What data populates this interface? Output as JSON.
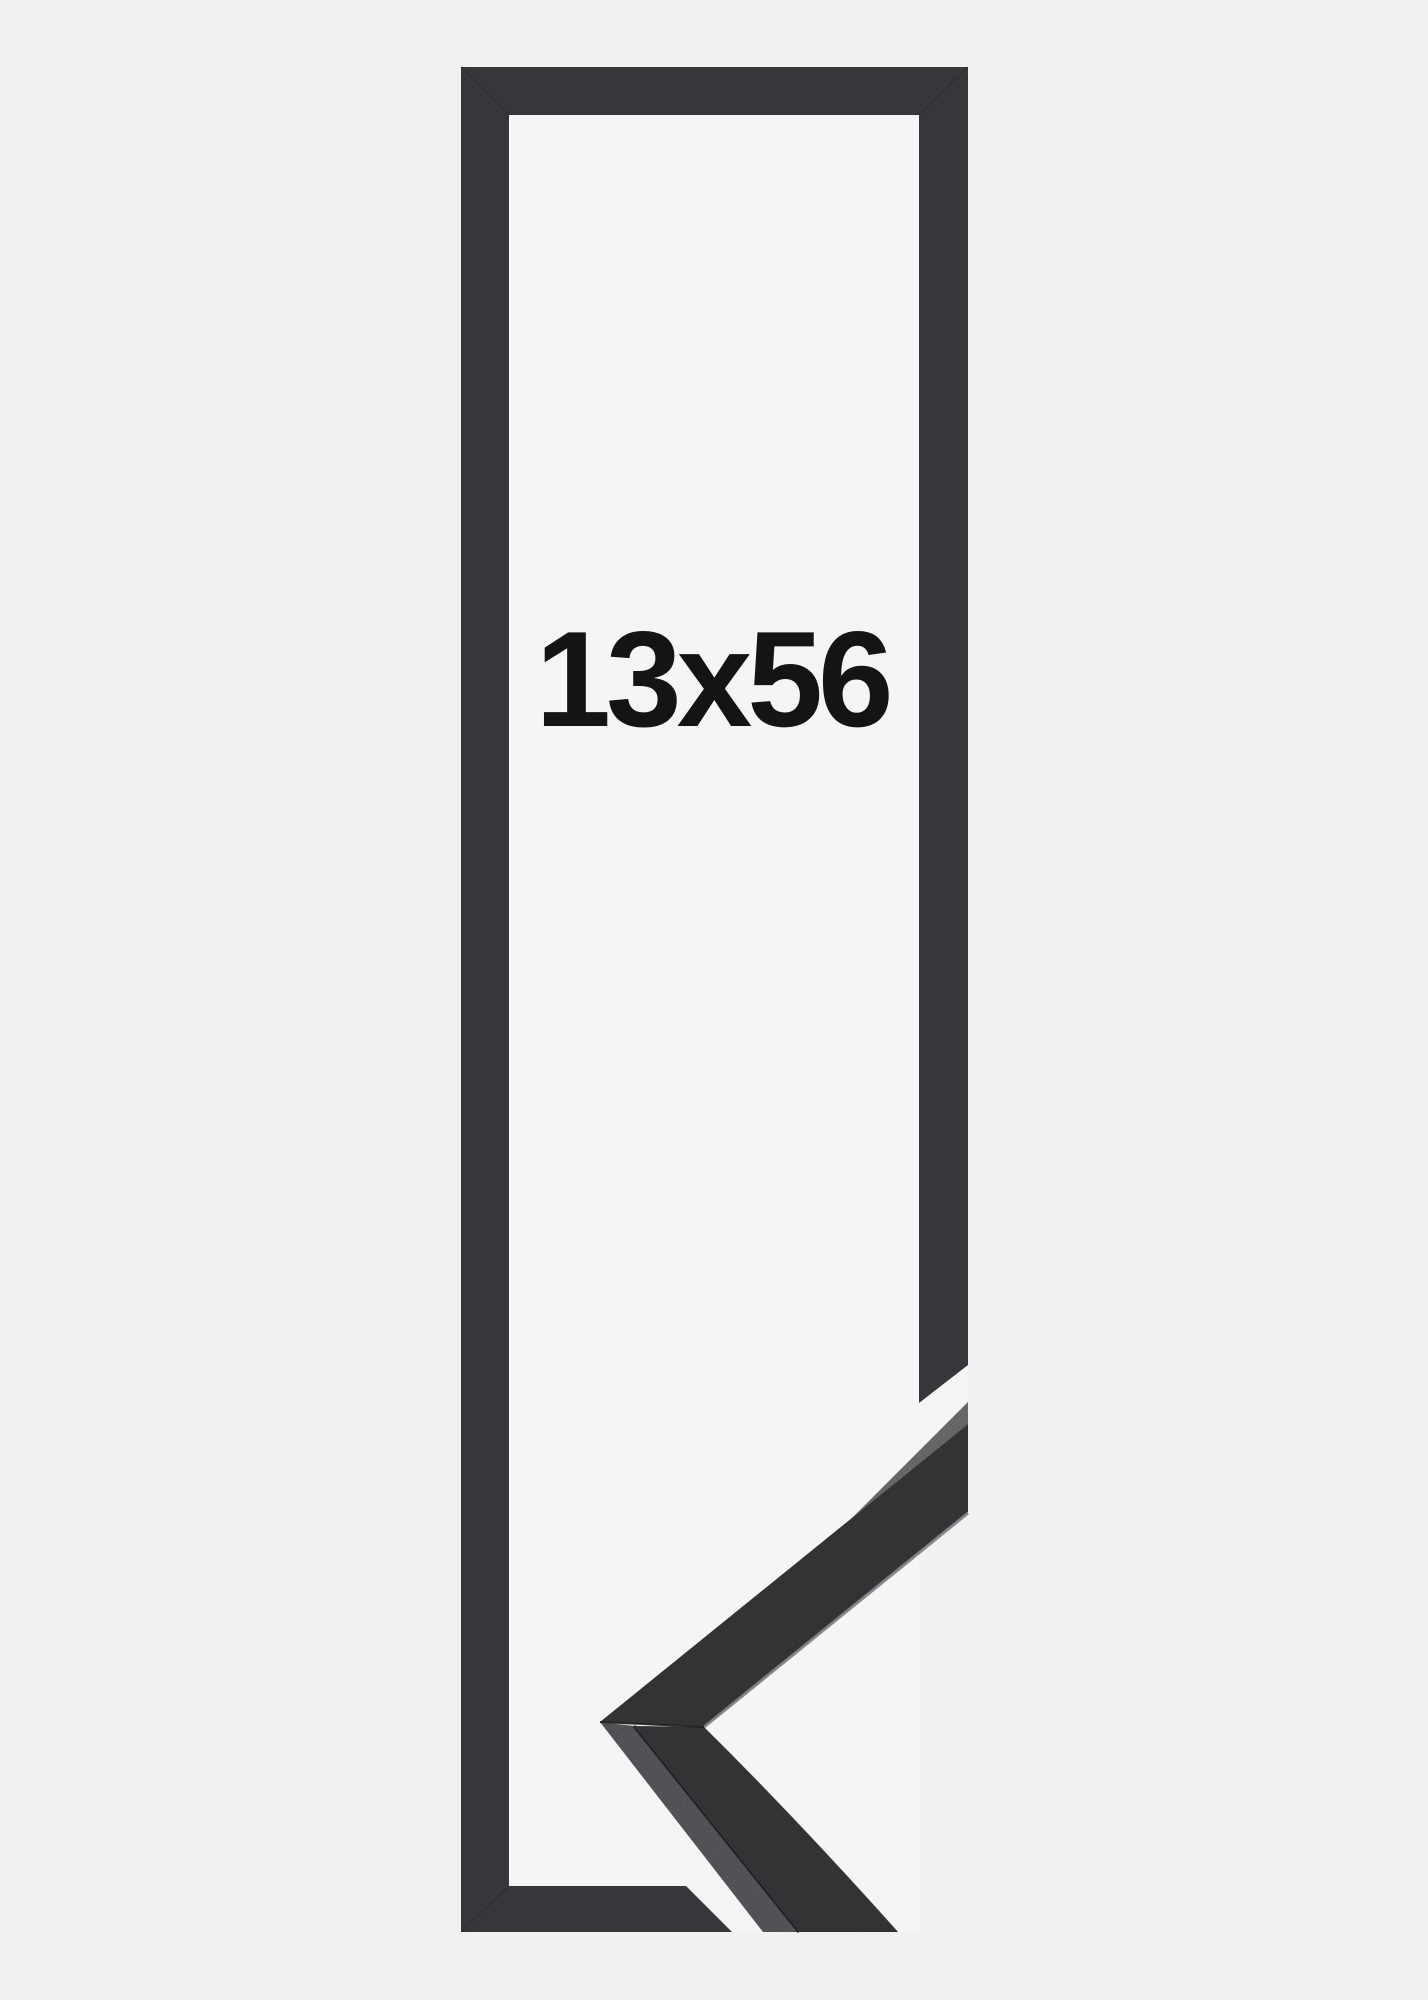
{
  "product_image": {
    "size_label": "13x56"
  },
  "colors": {
    "page-bg": "#f0f1f1",
    "inner-bg": "#f5f5f6",
    "frame-fill": "#36373a",
    "photo-face": "#3d3e41",
    "photo-side": "#606165",
    "photo-edge-highlight": "#939498",
    "seam": "#28292c",
    "label-text": "#141414"
  }
}
